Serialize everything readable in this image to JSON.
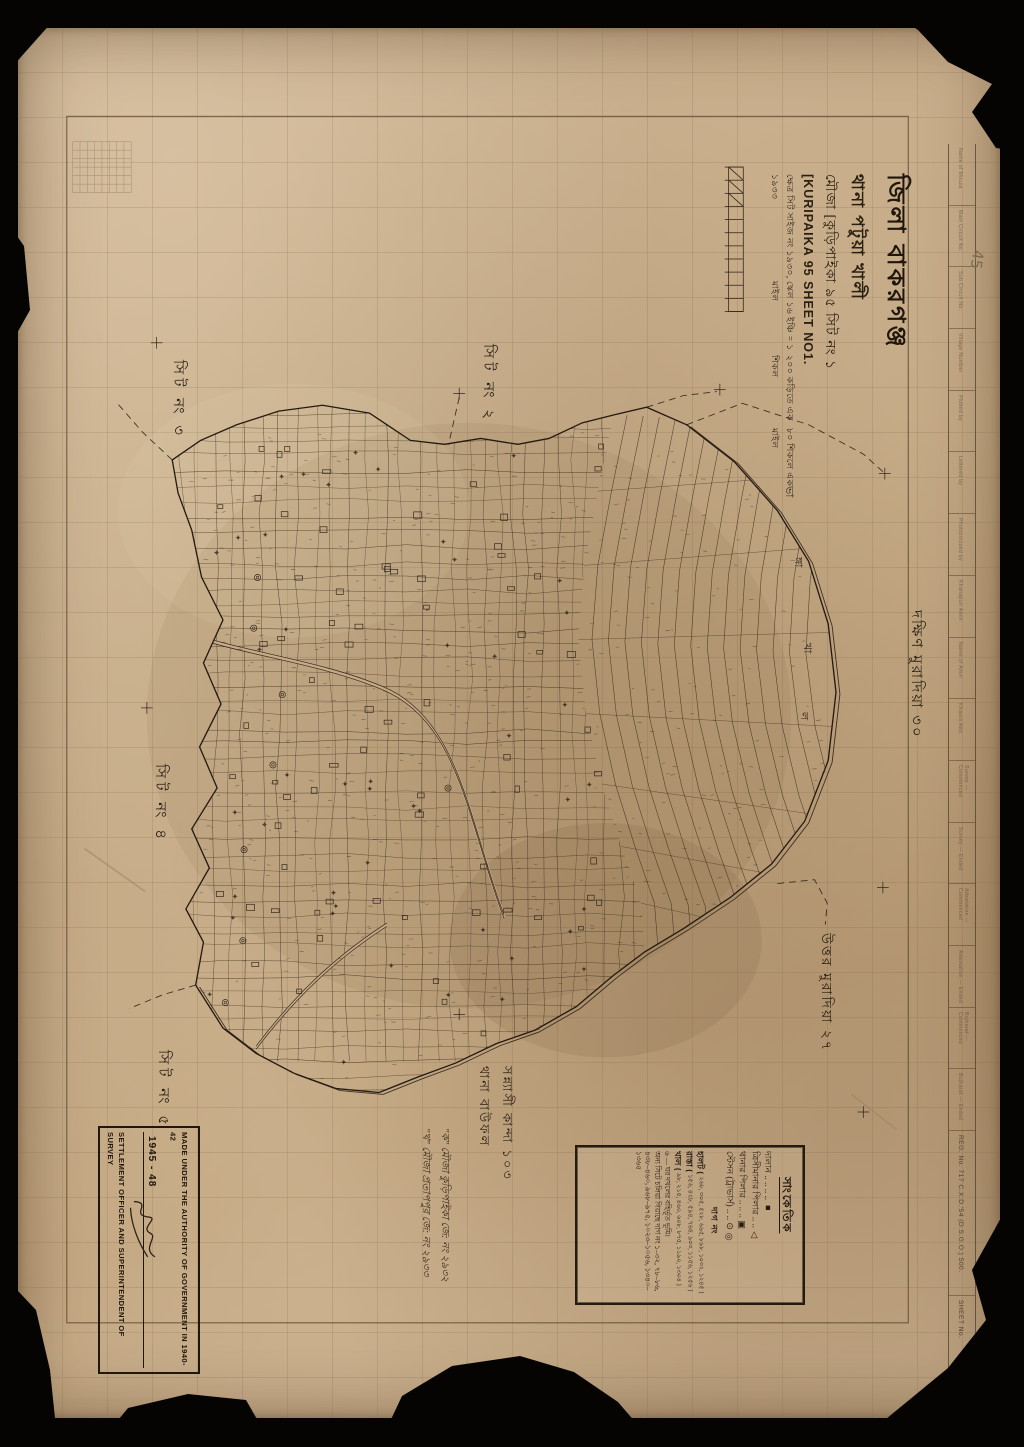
{
  "sheet": {
    "district": "জিলা বাকরগঞ্জ",
    "thana": "থানা পটুয়া খালী",
    "mouza_label": "মৌজা",
    "mouza_name_bn": "[কুড়িপাইকা ৯৫ সিট নং ১",
    "mouza_name_en": "[KURIPAIKA 95 SHEET NO1.",
    "detail_lines": [
      "ক্ষেত্র সিট সাইজ নং ১৯৩০, ১৯৩৩",
      "স্কেল ১৬ ইঞ্চি = ১ মাইল",
      "২০০ কড়িতে এক শিকল",
      "৮০ শিকলে এক মাইল"
    ]
  },
  "adjacent": {
    "sheet2": "সিট নং ২",
    "sheet3": "সিট নং ৩",
    "sheet4": "সিট নং ৪",
    "sheet5": "সিট নং ৫",
    "south_muradia": "দক্ষিণ মুরাদিয়া ৩০",
    "north_muradia": "উত্তর মুরাদিয়া ২৭",
    "sannyasi_kanda": "সন্ন্যাসী কান্দা ১০৩",
    "thana_bauphal": "থানা বাউফল"
  },
  "river_label_chars": [
    "ভা",
    "ঙ্গা",
    "খা",
    "ল"
  ],
  "legend": {
    "heading": "সাংকেতিক",
    "symbol_entries": [
      {
        "label": "দালান",
        "leader": ".. .. .. ..",
        "symbol": "■"
      },
      {
        "label": "ত্রিসীমানার পিলার",
        "leader": ".. ..",
        "symbol": "△"
      },
      {
        "label": "থানার পিলার",
        "leader": ".. .. ..",
        "symbol": "▣"
      },
      {
        "label": "স্টেসন (ট্রাভার্স)",
        "leader": ".. ..",
        "symbol": "⊙ ◎"
      }
    ],
    "dag_heading": "দাগ নং",
    "dag_entries": [
      {
        "label": "হালট",
        "numbers": "২৬৮, ৩০৫, ৫২৮, ৬৯৫, ৮৯৮, ১০৩২, ১২৪৫"
      },
      {
        "label": "রাস্তা",
        "numbers": "১৫৬, ৪২৮, ৫৯৪, ৭৬৪, ৯০৩, ১১৫৬, ১২৫৬"
      },
      {
        "label": "খাল",
        "numbers": "৯৮, ২১৫, ৪৬০, ৬০৮, ৮৭৫, ১১৯০, ১৩০৪"
      }
    ],
    "notes": [
      "৬ — ঘর দখলের বহির্ভূত ভূমি।",
      "অন্য সিটে চলিয়া গিয়াছে দাগ নং ১–৩২, ৭৮–৮৬, ৪৩৮–৪৬০, ৯৬৮–৯৭৫, ১০২৩–১০৫৬, ১৩৪০–১৩৬৫"
    ]
  },
  "stamp": {
    "line1": "MADE UNDER THE AUTHORITY OF GOVERNMENT IN 1940-42",
    "years": "1945 - 48",
    "line2": "SETTLEMENT OFFICER AND SUPERINTENDENT OF SURVEY"
  },
  "footnotes": [
    "\"ক\" মৌজা কুড়িপাইকা জে: নং ২৯৩২",
    "\"খ\" মৌজা প্রতাপপুর জে: নং ২৯৩৩"
  ],
  "margin_form": {
    "cells": [
      "Name of Mouza",
      "Main Circuit No.",
      "Sub Circuit No.",
      "Village Number",
      "Plotted by",
      "Lettered by",
      "Photozincoed by",
      "Khanapuri Amin",
      "Name of Amin",
      "Khasra Attd.",
      "Survey — Commenced",
      "Survey — Ended",
      "Attestation — Commenced",
      "Attestation — Ended",
      "Bujharat — Commenced",
      "Bujharat — Ended"
    ]
  },
  "corner": {
    "reg_no": "REG. No. 717 C.X.D.'54 (D.S.G.O.) 500.",
    "sheet_no": "SHEET No."
  },
  "pencil": {
    "right_edge_mark": "45"
  },
  "colors": {
    "paper": "#c8ad8a",
    "ink": "#2f2416",
    "pencil": "#8a7459",
    "backing": "#050403"
  }
}
